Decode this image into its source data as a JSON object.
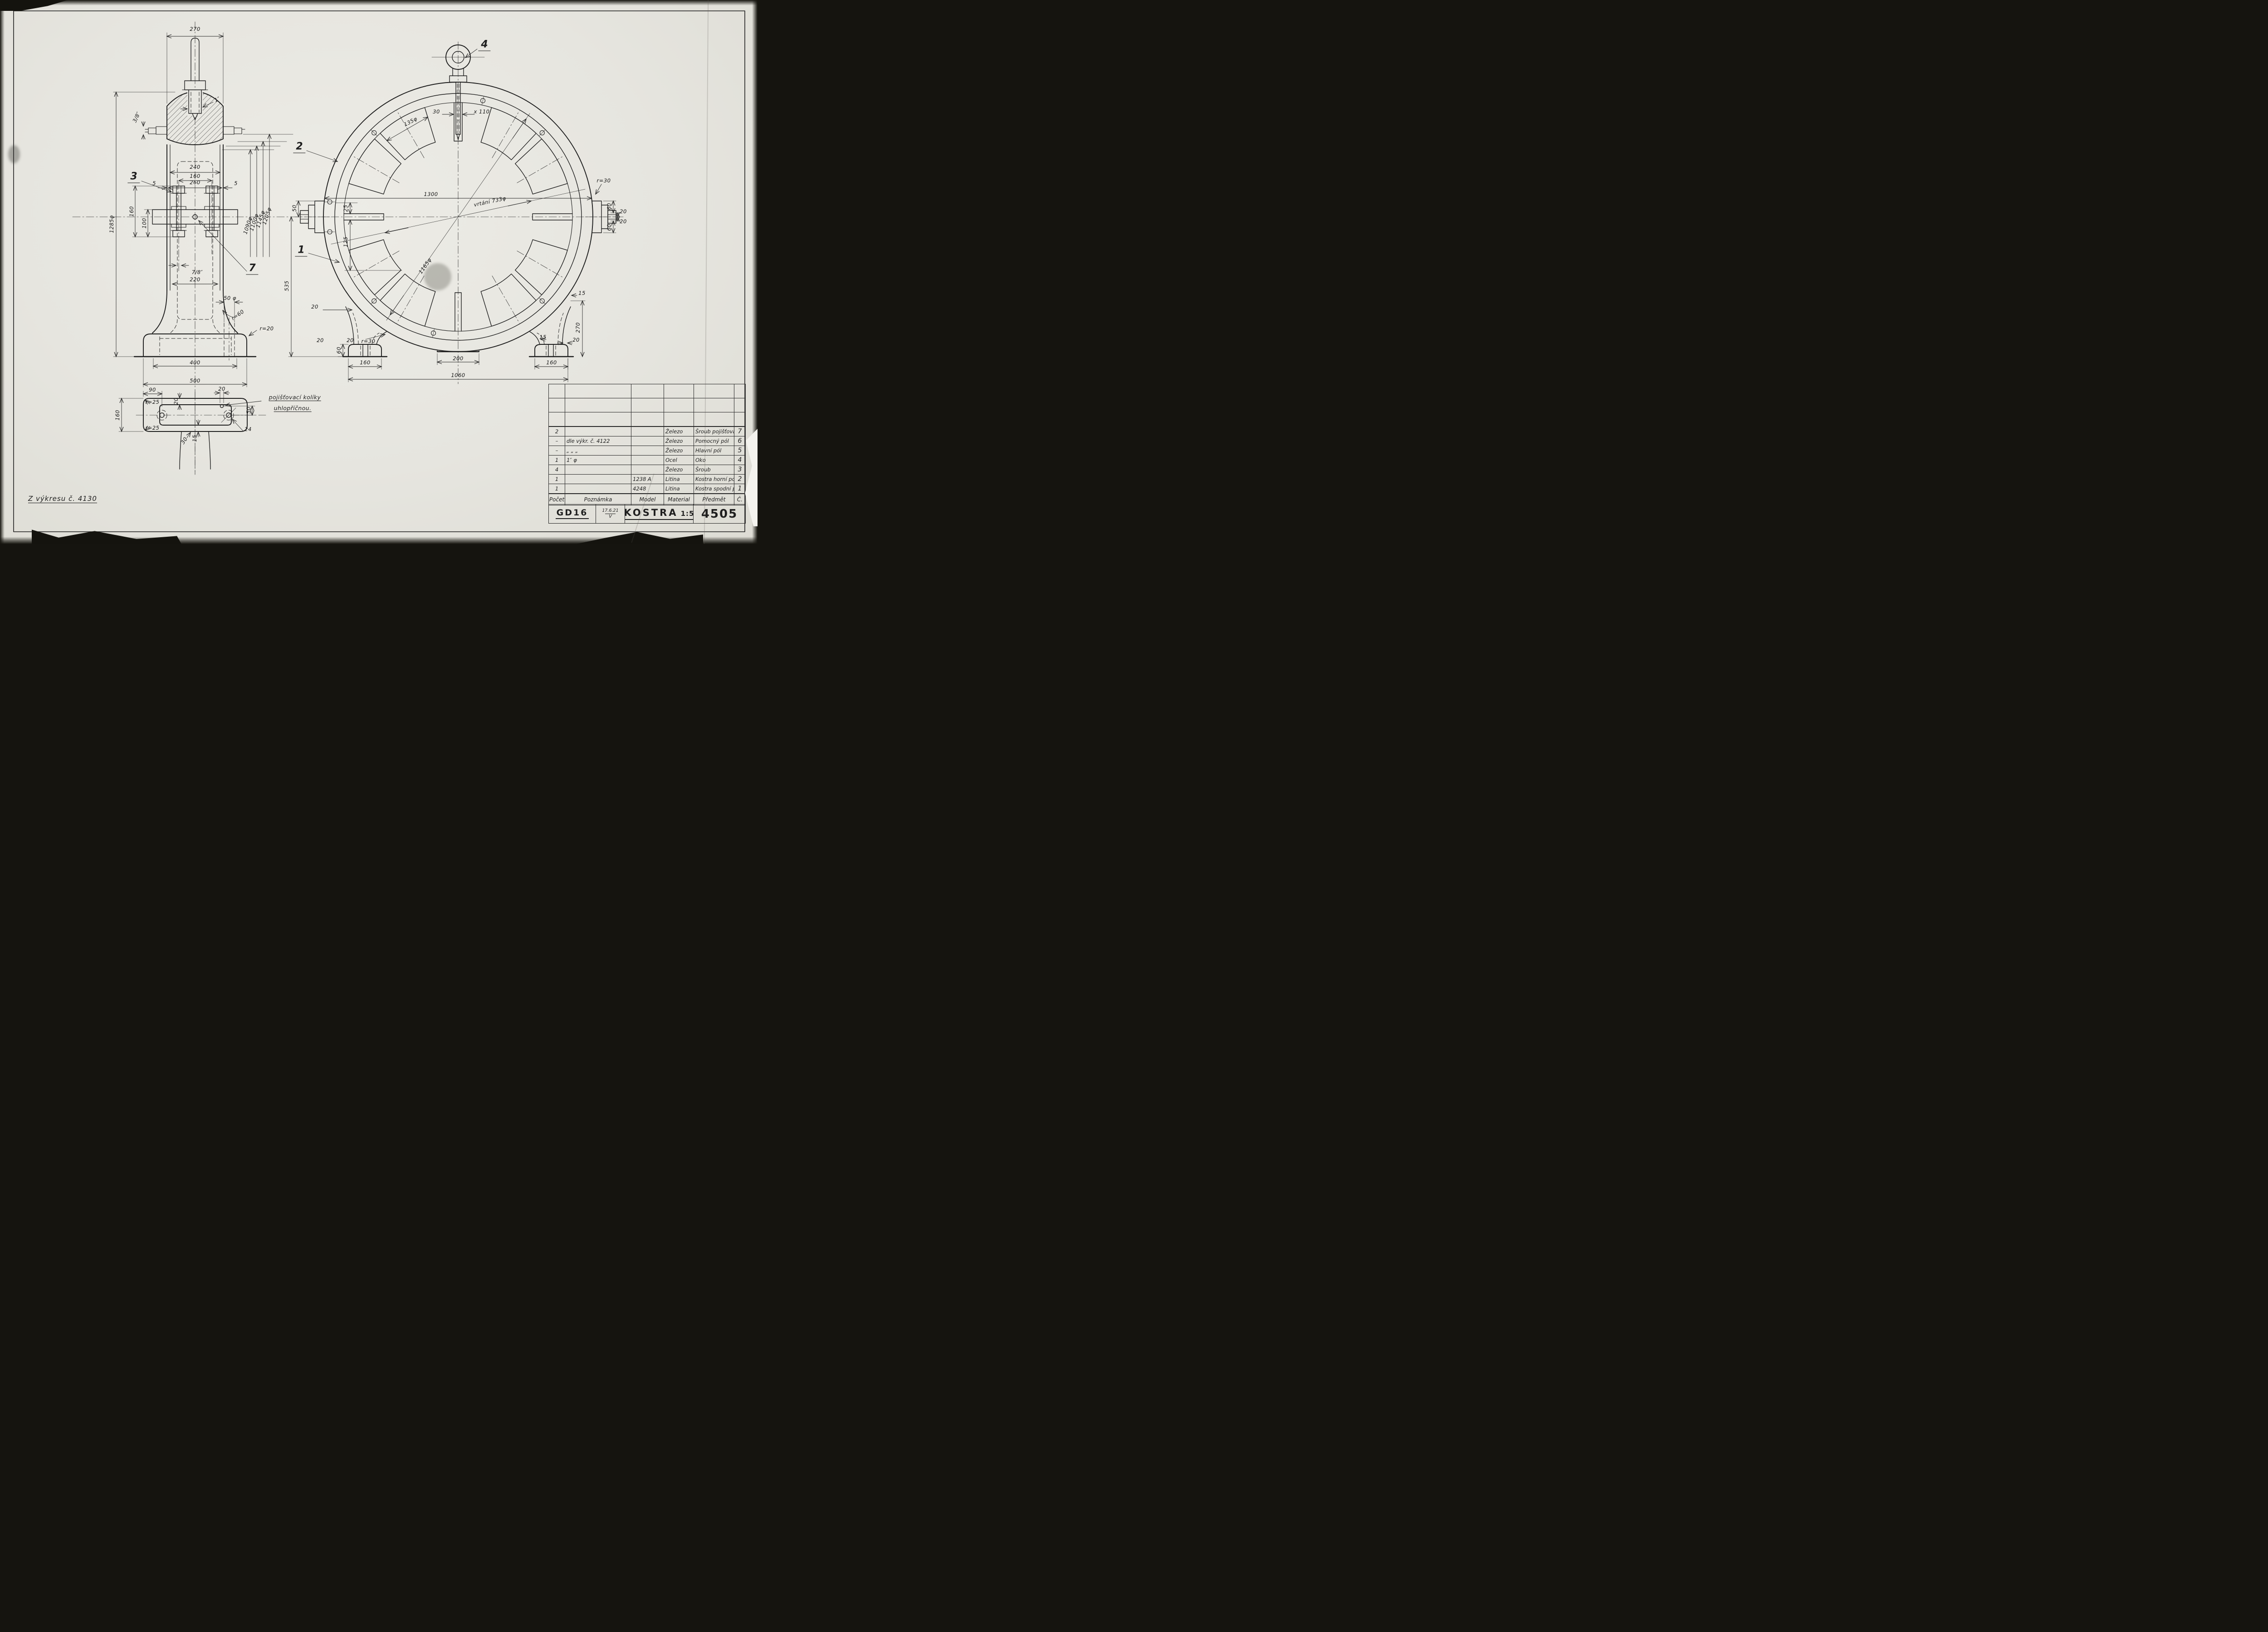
{
  "sheet": {
    "source_note": "Z výkresu č. 4130",
    "pin_note_line1": "pojišťovací kolíky",
    "pin_note_line2": "uhlopříčnou."
  },
  "callouts": {
    "c1": "1",
    "c2": "2",
    "c3": "3",
    "c4": "4",
    "c7": "7"
  },
  "side_view": {
    "dims": {
      "w_top": "270",
      "step": "3/8″",
      "w_win_in": "240",
      "w_win_out": "260",
      "wall_l": "5",
      "wall_r": "5",
      "bolt_eye": "1″",
      "bolt_sp": "160",
      "fl_h": "160",
      "fl_sp": "100",
      "h_all": "1285φ",
      "d1": "1090φ",
      "d2": "1100φ",
      "d3": "1145φ",
      "d4": "1205φ",
      "bolt_d": "7/8″",
      "w_col": "220",
      "fil_r": "r=60",
      "hole": "50 φ",
      "foot_r": "r=20",
      "w_foot_in": "400",
      "w_foot": "500"
    }
  },
  "plan_view": {
    "dims": {
      "off_hole": "90",
      "wall": "20",
      "pin_off": "20",
      "h": "160",
      "pin_y": "50",
      "hole_d": "24",
      "r_tl": "r=25",
      "r_bl": "r=25",
      "ang": "30",
      "lip": "15"
    }
  },
  "front_view": {
    "dims": {
      "d_out": "1300",
      "bore": "vrtání 733φ",
      "bolt_circle": "1165φ",
      "pole_d": "135φ",
      "slot_w": "30",
      "slot_l": "x 110",
      "lug_off": "25",
      "pole_off": "125",
      "lug_h": "50",
      "h_half": "535",
      "lf_a": "20",
      "lf_h": "60",
      "lf_b": "20",
      "lf_c": "20",
      "lf_r": "r=30",
      "lf_w": "160",
      "flat": "200",
      "span": "1060",
      "rf_lip": "15",
      "rf_rib": "15",
      "rf_b": "20",
      "rf_w": "160",
      "rf_h": "270",
      "rl_r": "r=30",
      "rl_a": "60",
      "rl_b": "20",
      "rl_c": "20",
      "rl_d": "60"
    }
  },
  "parts_table": {
    "headers": {
      "qty": "Počet",
      "note": "Poznámka",
      "model": "Model",
      "material": "Material",
      "item": "Předmět",
      "no": "Č."
    },
    "rows": [
      {
        "qty": "2",
        "note": "",
        "model": "",
        "material": "Železo",
        "item": "Šroub pojišťovací",
        "no": "7"
      },
      {
        "qty": "–",
        "note": "dle výkr. č. 4122",
        "model": "",
        "material": "Železo",
        "item": "Pomocný pól",
        "no": "6"
      },
      {
        "qty": "–",
        "note": "„   „   „",
        "model": "",
        "material": "Železo",
        "item": "Hlavní pól",
        "no": "5"
      },
      {
        "qty": "1",
        "note": "1″ φ",
        "model": "",
        "material": "Ocel",
        "item": "Oko",
        "no": "4"
      },
      {
        "qty": "4",
        "note": "",
        "model": "",
        "material": "Železo",
        "item": "Šroub",
        "no": "3"
      },
      {
        "qty": "1",
        "note": "",
        "model": "1238 A",
        "material": "Litina",
        "item": "Kostra horní pol.",
        "no": "2"
      },
      {
        "qty": "1",
        "note": "",
        "model": "4248",
        "material": "Litina",
        "item": "Kostra spodní pol.",
        "no": "1"
      }
    ]
  },
  "title_block": {
    "org": "GD16",
    "date": "17.6.21",
    "date_mark": "V",
    "title": "KOSTRA",
    "scale": "1:5",
    "number": "4505"
  }
}
